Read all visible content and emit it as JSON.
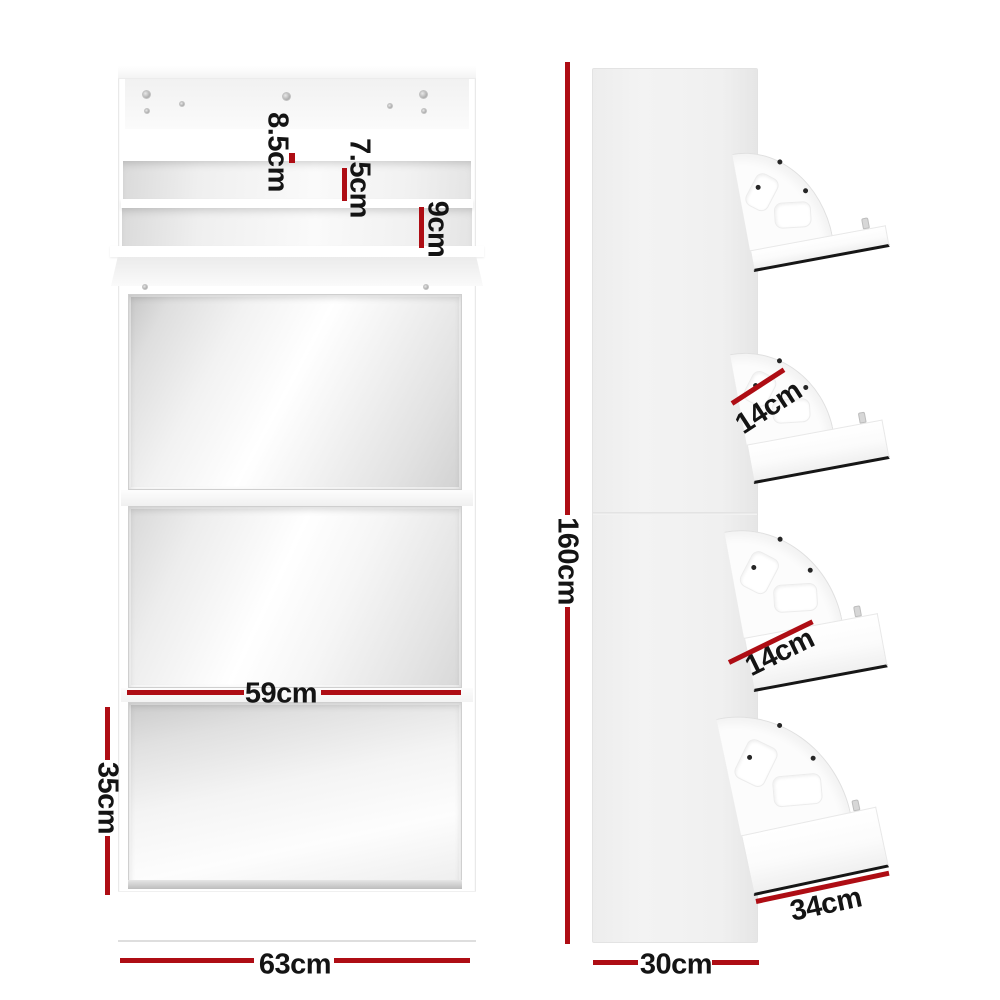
{
  "front_view": {
    "dimensions": {
      "top_slot": "8.5cm",
      "middle_slot": "7.5cm",
      "bottom_slot": "9cm",
      "mirror_width": "59cm",
      "bottom_drawer_height": "35cm",
      "overall_width": "63cm"
    }
  },
  "side_view": {
    "dimensions": {
      "overall_height": "160cm",
      "upper_shelf_depth": "14cm",
      "lower_shelf_depth": "14cm",
      "flap_depth": "34cm",
      "overall_depth": "30cm"
    }
  },
  "colors": {
    "dimension_line": "#ae0d14",
    "label_text": "#141414",
    "cabinet_white": "#ffffff",
    "side_panel_gray": "#f0f0f0",
    "mirror_silver": "#d8d8d8"
  }
}
